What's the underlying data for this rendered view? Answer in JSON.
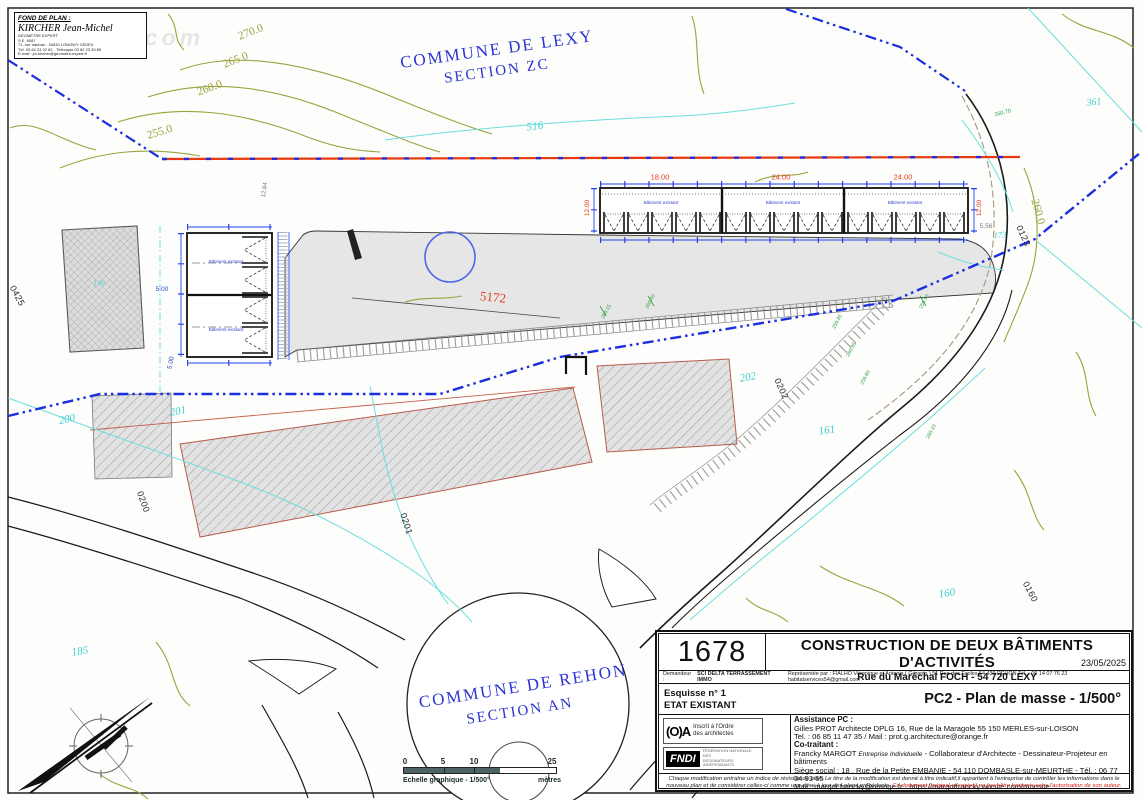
{
  "watermark": "proprio.com",
  "stamp": {
    "heading": "FOND DE PLAN :",
    "name": "KIRCHER Jean-Michel",
    "line1": "GEOMETRE EXPERT",
    "line2": "S.E. 6087",
    "line3": "71, rue Vauban - 54810 LONGWY CEDEX",
    "line4": "Tél. 03 82 23 22 82 - Télécopie 03 82 23 39 85",
    "line5": "E-mail : jm.kircher@geometre-expert.fr"
  },
  "plan": {
    "commune_top": {
      "name": "COMMUNE DE LEXY",
      "section": "SECTION ZC"
    },
    "commune_bottom": {
      "name": "COMMUNE DE REHON",
      "section": "SECTION AN"
    },
    "contours": {
      "c270": "270.0",
      "c265": "265.0",
      "c260": "260.0",
      "c255": "255.0",
      "c260r": "260.0"
    },
    "parcel_red": "5172",
    "parcels_cyan": {
      "p516": "516",
      "p199": "199",
      "p200": "200",
      "p201": "201",
      "p202": "202",
      "p161": "161",
      "p160": "160",
      "p185": "185",
      "p173": "173",
      "p361": "361"
    },
    "parcels_black": {
      "p0425": "0425",
      "p0200": "0200",
      "p0201": "0201",
      "p0202": "0202",
      "p0160": "0160",
      "p0123": "0123"
    },
    "dims": {
      "d18": "18.00",
      "d24a": "24.00",
      "d24b": "24.00",
      "dv_left": "12.00",
      "dv_right": "12.00",
      "d556": "5.56",
      "d1284": "12.84",
      "d500a": "5.00",
      "d500b": "5.00"
    },
    "building_label": "Bâtiment existant",
    "elevations": {
      "e0": "260.70",
      "e1": "260.15",
      "e2": "260.40",
      "e3": "259.85",
      "e4": "260.35",
      "e5": "259.60",
      "e6": "259.90",
      "e7": "260.10"
    }
  },
  "scalebar": {
    "t0": "0",
    "t5": "5",
    "t10": "10",
    "t25": "25",
    "caption": "Echelle graphique - 1/500°",
    "unit": "mètres"
  },
  "titleblock": {
    "number": "1678",
    "title": "CONSTRUCTION DE DEUX BÂTIMENTS D'ACTIVITÉS",
    "subtitle": "Rue du Maréchal FOCH   -   54 720 LEXY",
    "date": "23/05/2025",
    "demandeur_label": "Demandeur :",
    "demandeur_name": "SCI DELTA TERRASSEMENT IMMO",
    "demandeur_rest": "Représentée par :   FIALHO Véronique  et Antonio   ( Gérants )   51  Rue des Ecoles   54 430  REHON   Tél. : 06 14 07 76 23   habitatservices54@gmail.com",
    "esquisse": "Esquisse n° 1",
    "etat": "ETAT EXISTANT",
    "doc_ref": "PC2 - Plan de masse - 1/500°",
    "ordre": {
      "glyph": "(O)A",
      "l1": "Inscrit à l'Ordre",
      "l2": "des architectes"
    },
    "fndi": {
      "abbr": "FNDI",
      "l1": "FÉDÉRATION NATIONALE DES",
      "l2": "DESSINATEURS INDÉPENDANTS"
    },
    "assistance": {
      "heading": "Assistance PC :",
      "line1": "Gilles PROT Architecte DPLG 16, Rue de la Maragole 55 150 MERLES-sur-LOISON",
      "line2": "Tel. : 06 85 11 47 35 / Mail : prot.g.architecture@orange.fr"
    },
    "cotraitant": {
      "heading": "Co-traitant :",
      "name": "Francky MARGOT ",
      "ei": "Entreprise Individuelle",
      "role": " - Collaborateur d'Architecte - Dessinateur-Projeteur en bâtiments",
      "line2": "Siège social :  18 , Rue de la Petite EMBANIE - 54 110 DOMBASLE-sur-MEURTHE  - Tél. : 06 77 34 93 65",
      "line3": "Mail : margot.francky@orange.fr    -    https://margotfrancky.wixsite.com/monsite"
    },
    "footer_black": "Chaque modification entraîne un indice de révision du plan. Le titre de la modification est donné à titre indicatif,il appartient à  l'entreprise de contrôler les informations dans le nouveau plan et de considérer celles-ci comme une mise à jour des plans précédents. ",
    "footer_red": "Ce document (original et copies) ne peut être transmis sans l'autorisation de son auteur."
  }
}
